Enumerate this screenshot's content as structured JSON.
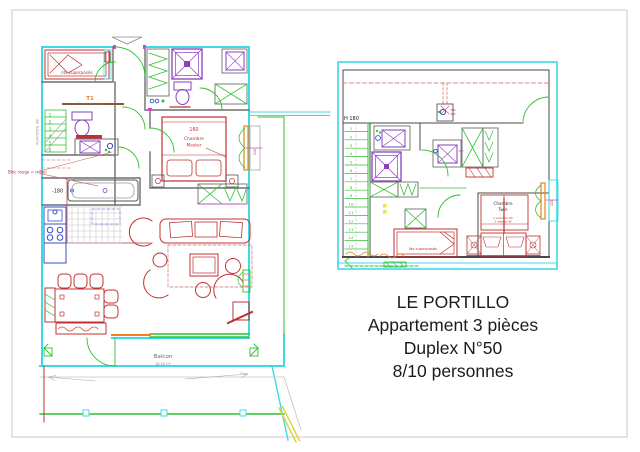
{
  "document": {
    "type": "architectural-floor-plan",
    "sheet_border_color": "#c9c9c9",
    "background": "#ffffff"
  },
  "colors": {
    "exterior_wall_cyan": "#3fd9e4",
    "door_window_green": "#2fc12f",
    "furniture_red": "#c03030",
    "fixture_purple": "#8a3fc0",
    "kitchen_blue": "#3a50c8",
    "accent_orange": "#f08018",
    "accent_magenta": "#d840d8",
    "interior_wall_gray": "#6e6e6e",
    "dashed_red": "#d86060",
    "property_yellow": "#ddd23a",
    "title_text": "#1b1b1b"
  },
  "title_block": {
    "lines": [
      "LE PORTILLO",
      "Appartement 3 pièces",
      "Duplex N°50",
      "8/10 personnes"
    ]
  },
  "floor1": {
    "name": "niveau bas",
    "labels": {
      "bunk_bed": "lits superposés",
      "t1": "T1",
      "t1_note": "(lit haut et lit bas)",
      "placo_note": "PLACOSTIL 98",
      "mirror_note": "Bloc rouge = miroir",
      "bath_level": "-180",
      "bed_size": "160",
      "master_line1": "Chambre",
      "master_line2": "Master",
      "balcony": "Balcon",
      "balcony_area": "18,50 m²",
      "window_dim": "115",
      "stairs": [
        "1",
        "2",
        "3",
        "4",
        "5",
        "6"
      ]
    }
  },
  "floor2": {
    "name": "niveau haut",
    "labels": {
      "height_note": "H 180",
      "twin_line1": "Chambre",
      "twin_line2": "Twin",
      "twin_note1": "2 sommiers 90",
      "twin_note2": "2 matelas 90",
      "bunk_bed": "lits superposés",
      "window_dim": "115",
      "stairs": [
        "1",
        "2",
        "3",
        "4",
        "5",
        "6",
        "7",
        "8",
        "9",
        "10",
        "11",
        "12",
        "13",
        "14",
        "15"
      ]
    }
  }
}
